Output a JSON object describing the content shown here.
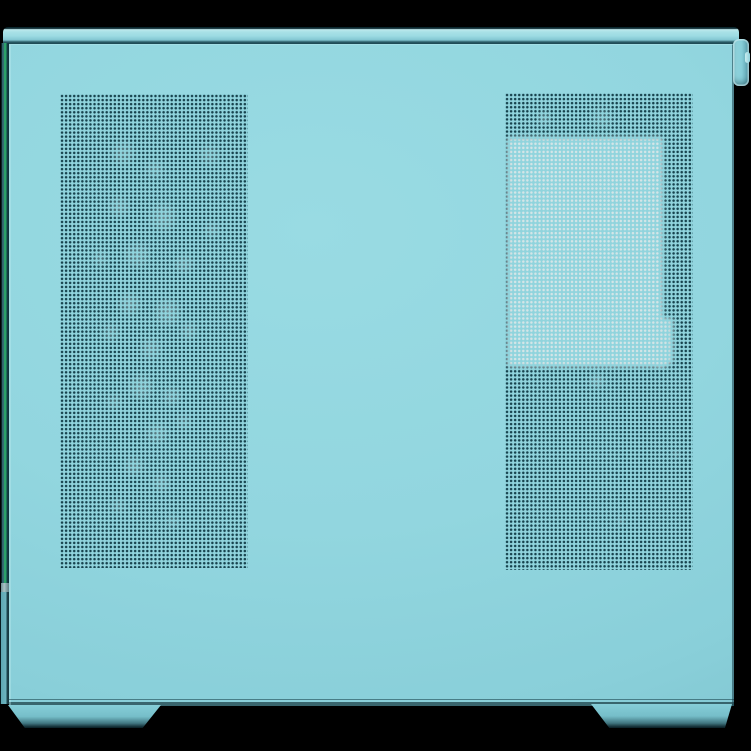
{
  "scene": {
    "type": "product-photo",
    "subject": "Teal desktop PC case, mesh side panel view, studio shot",
    "background_color": "#000000"
  },
  "palette": {
    "panel_teal": "#92d6df",
    "panel_teal_light": "#9cdbe3",
    "panel_teal_dark": "#7fc4cf",
    "top_edge_highlight": "#bfe9ed",
    "mesh_hole_dark": "#17434e",
    "light_through_mesh": "#d4e5e7",
    "glass_edge_green": "#2ba169",
    "foot_shadow": "#0b2026",
    "background": "#000000"
  },
  "parts": {
    "top_strip": {
      "label": "Top panel edge of the case"
    },
    "handle_tab": {
      "label": "Side panel pull tab / latch at top right"
    },
    "glass_edge": {
      "label": "Front tempered glass edge showing green tint"
    },
    "front_lower_edge": {
      "label": "Front panel lower edge"
    },
    "body_panel": {
      "label": "Steel mesh side panel, teal finish"
    },
    "mesh_left": {
      "label": "Left perforated ventilation zone (front fans area)"
    },
    "mesh_right": {
      "label": "Right perforated ventilation zone (PSU chamber area)"
    },
    "light_window": {
      "label": "Light object visible through rear mesh perforation"
    },
    "foot_left": {
      "label": "Front case foot"
    },
    "foot_right": {
      "label": "Rear case foot"
    }
  }
}
